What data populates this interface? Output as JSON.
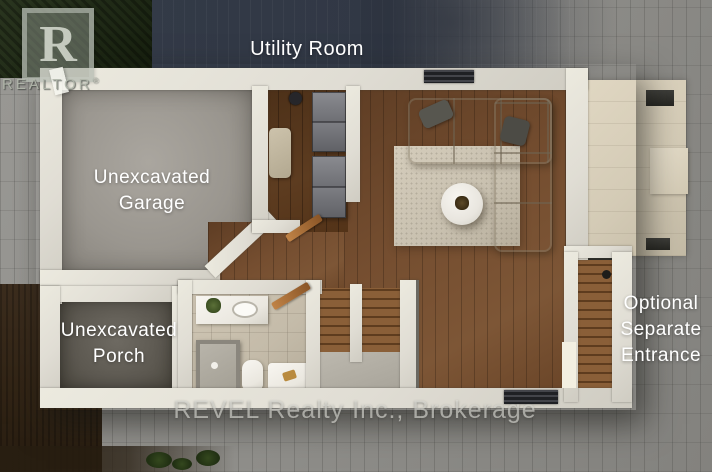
{
  "labels": {
    "utility_room": "Utility Room",
    "garage": {
      "line1": "Unexcavated",
      "line2": "Garage"
    },
    "porch": {
      "line1": "Unexcavated",
      "line2": "Porch"
    },
    "separate_entrance": {
      "line1": "Optional",
      "line2": "Separate",
      "line3": "Entrance"
    }
  },
  "watermarks": {
    "realtor_logo_letter": "R",
    "realtor_text": "REALTOR",
    "registered_symbol": "®",
    "brokerage": "REVEL Realty Inc., Brokerage"
  },
  "palette": {
    "paving_gray": "#8f8e8b",
    "driveway_slate": "#323947",
    "hedge_green": "#222d1a",
    "soil_brown": "#34271a",
    "wall_white": "#e5e2da",
    "garage_concrete": "#9c988f",
    "porch_concrete": "#5f5b54",
    "hardwood_brown": "#6f4b2f",
    "sofa_beige": "#c9c1b1",
    "rug_beige": "#cdc5b5",
    "bathroom_tile": "#c9c0ae",
    "patio_stone": "#d8cfbb",
    "label_text": "#ffffff",
    "watermark_gray": "#b9bdb4"
  }
}
